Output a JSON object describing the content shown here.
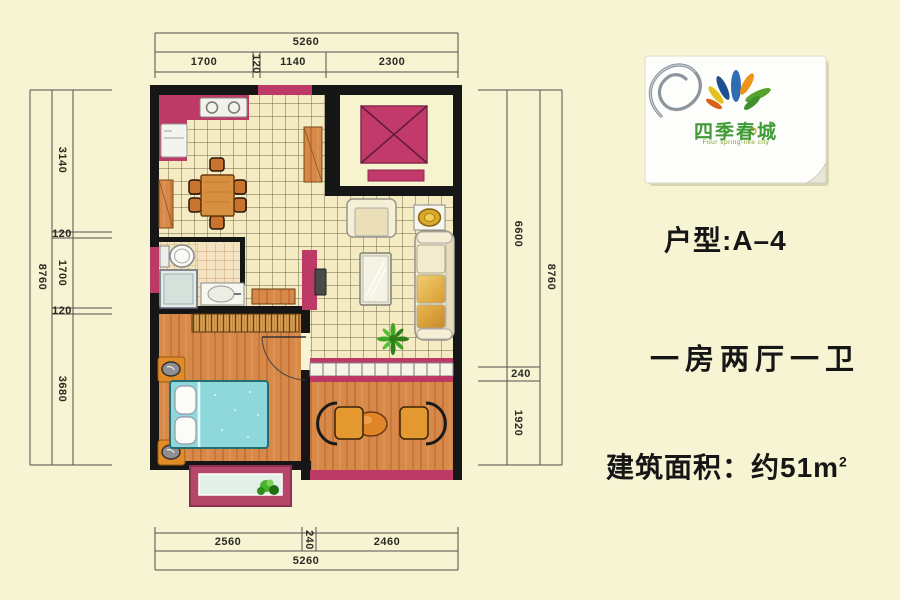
{
  "page": {
    "background": "#F7F4D4"
  },
  "dimensions": {
    "top": {
      "total": "5260",
      "seg1": "1700",
      "seg2": "120",
      "seg3": "1140",
      "seg4": "2300"
    },
    "bottom": {
      "seg1": "2560",
      "seg2": "240",
      "seg3": "2460",
      "total": "5260"
    },
    "left": {
      "total": "8760",
      "seg1": "3140",
      "seg2": "120",
      "seg3": "1700",
      "seg4": "120",
      "seg5": "3680"
    },
    "right": {
      "seg1": "6600",
      "seg2": "240",
      "seg3": "1920",
      "total": "8760"
    }
  },
  "logo": {
    "brand": "四季春城",
    "tagline": "Four spring-like city"
  },
  "info": {
    "unit_type": "户型:A–4",
    "layout": "一房两厅一卫",
    "area_prefix": "建筑面积：约51m",
    "area_exponent": "2"
  },
  "colors": {
    "accent_magenta": "#BE3A66",
    "wall_black": "#161616",
    "wood": "#D68948",
    "bed_cyan": "#8ED8DB",
    "logo_green": "#3E9B35"
  }
}
